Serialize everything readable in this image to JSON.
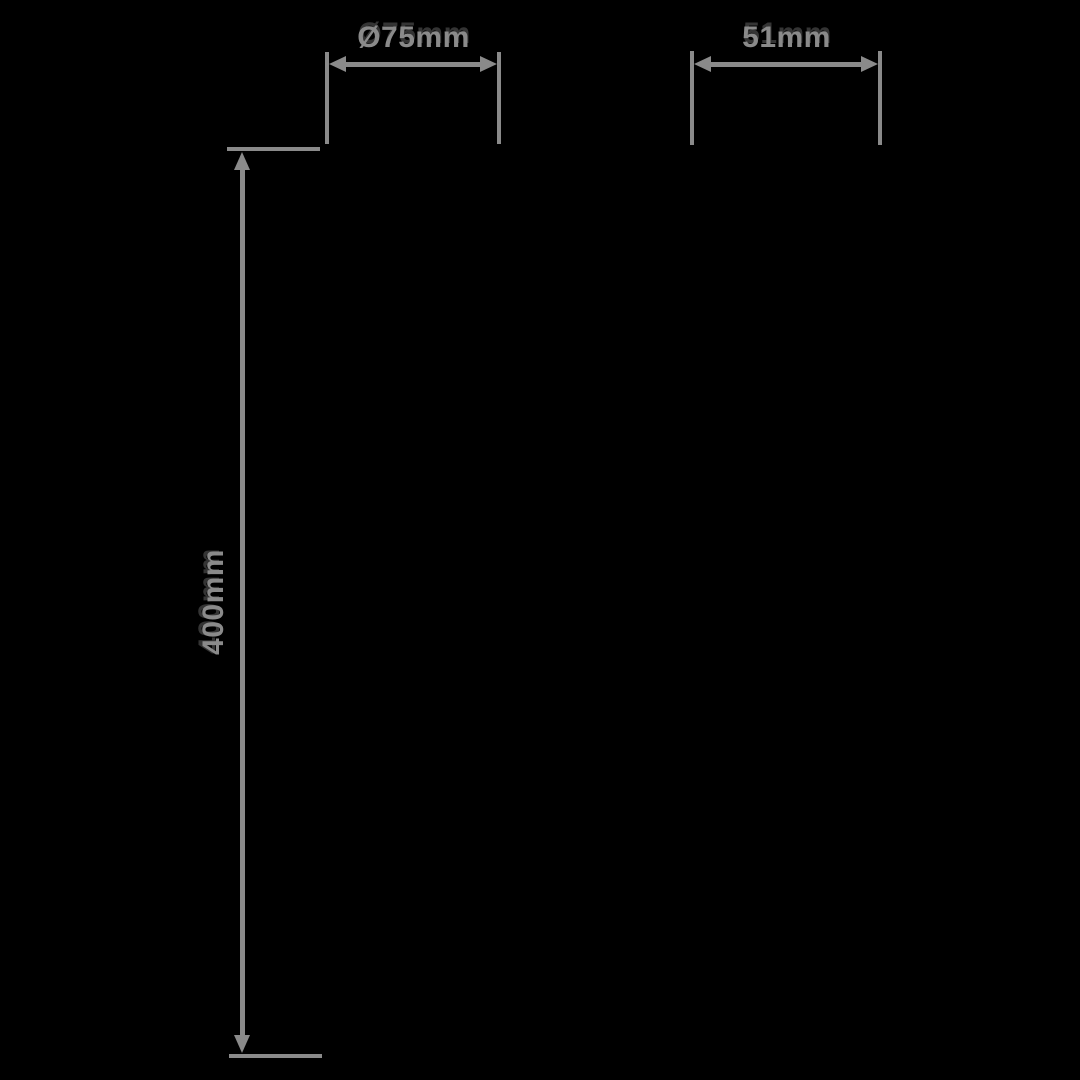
{
  "figure": {
    "background_color": "#000000",
    "line_color": "#8A8A8A",
    "label_color": "#8A8A8A"
  },
  "dimensions": {
    "diameter": {
      "label": "Ø75mm",
      "orientation": "horizontal"
    },
    "width": {
      "label": "51mm",
      "orientation": "horizontal"
    },
    "height": {
      "label": "400mm",
      "orientation": "vertical"
    }
  }
}
